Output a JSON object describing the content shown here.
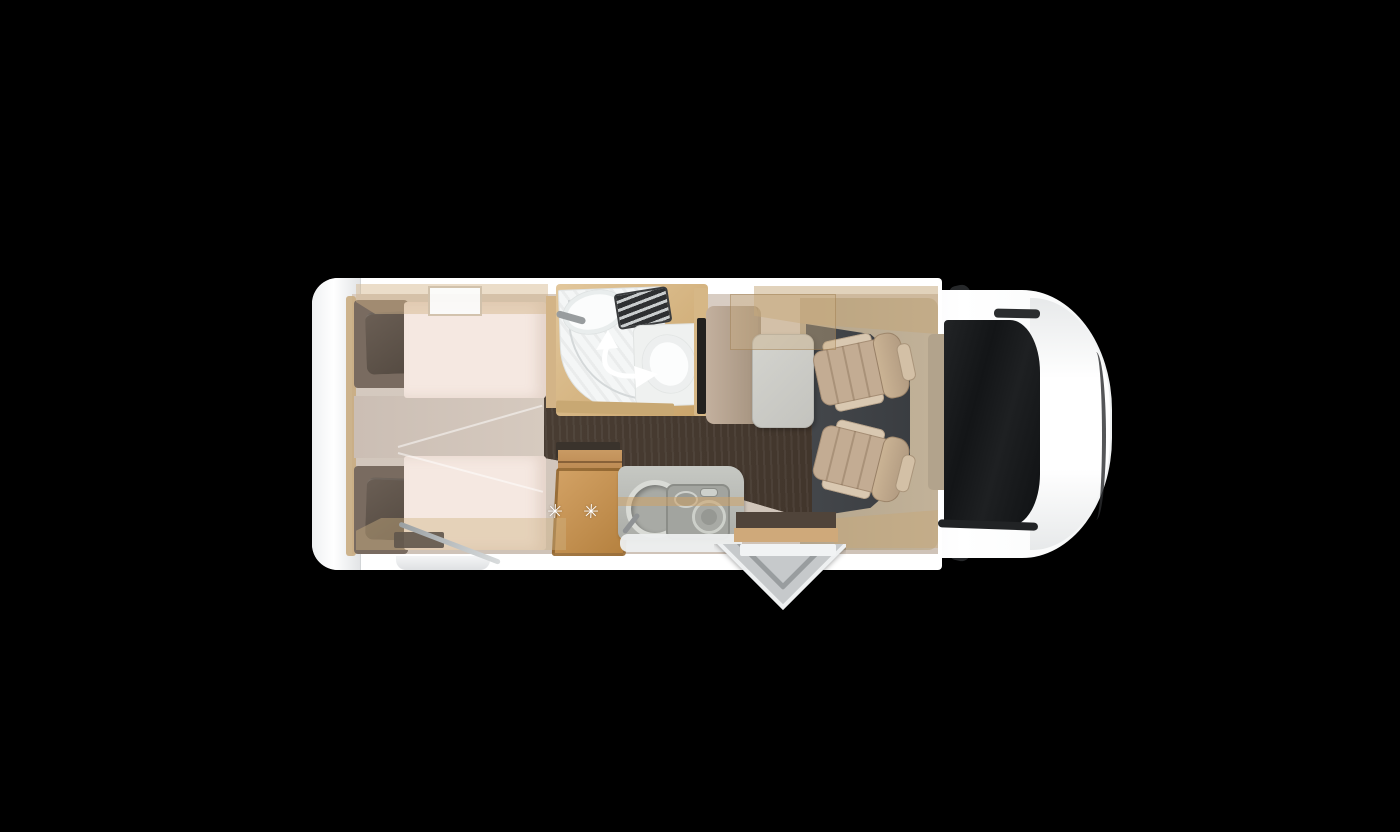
{
  "scene": {
    "background_color": "#000000",
    "subject": "motorhome-floorplan-top-view"
  },
  "fridge": {
    "stars_label": "✳ ✳ ✳"
  },
  "icons": {
    "shower_swivel_arrow": "curved-double-arrow",
    "fridge_stars": "three-six-point-asterisks",
    "side_mirrors": "dark-wing-mirrors"
  },
  "palette": {
    "body_white": "#ffffff",
    "body_shadow": "#e3e5e7",
    "interior_base": "#d6cabf",
    "wood_light": "#d9bc8f",
    "wood_dark": "#b8854d",
    "fridge_wood": "#c79757",
    "bed_mattress": "#f5e8e1",
    "bed_head_cushion": "#796b60",
    "pillow": "#5f544b",
    "aisle_floor": "#473a30",
    "cab_carpet": "#3e4145",
    "seat_beige": "#c3ac93",
    "table_grey": "#cdcdc8",
    "bench_taupe": "#b4a191",
    "counter_grey": "#b5b7b2",
    "stove_grey": "#a2a49f",
    "shower_white": "#f4f6f6",
    "windshield_black": "#1a1c1e",
    "mirror_dark": "#26282a",
    "dashboard_tan": "#b2a38c"
  }
}
